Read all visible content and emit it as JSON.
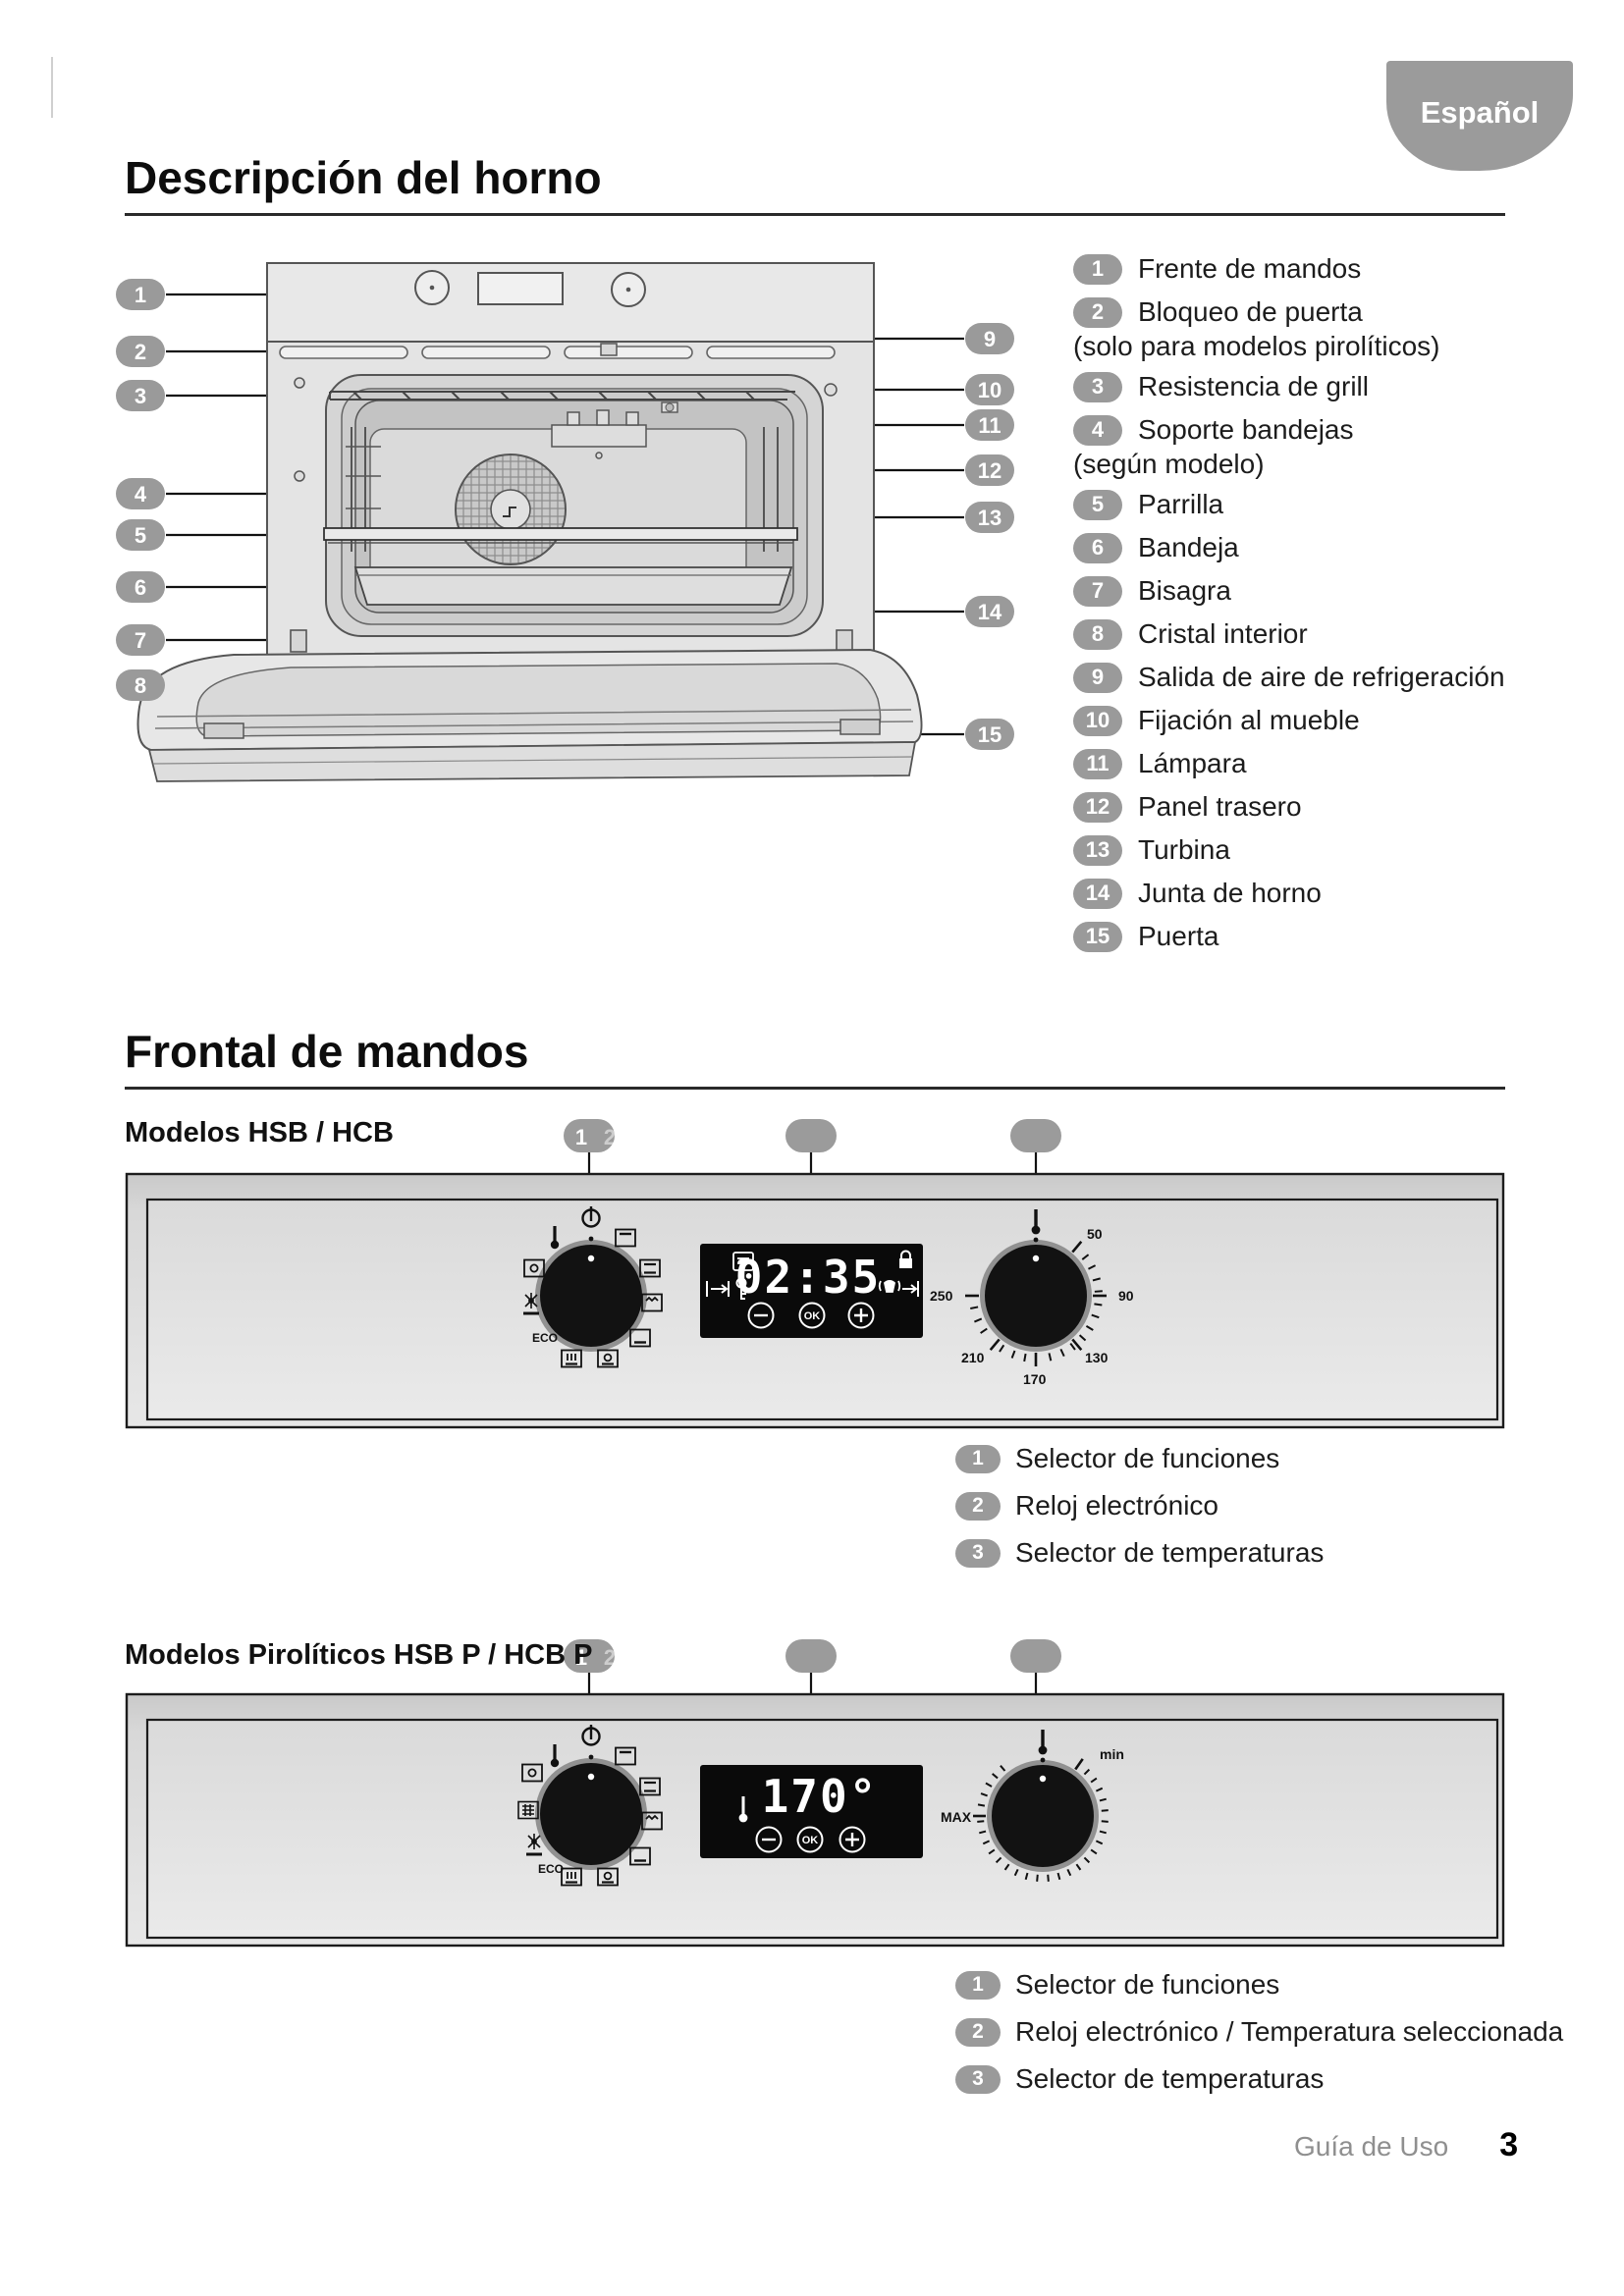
{
  "page": {
    "language_tab": "Español",
    "footer_label": "Guía de Uso",
    "page_number": "3"
  },
  "oven_description": {
    "title": "Descripción del horno",
    "callouts": [
      "1",
      "2",
      "3",
      "4",
      "5",
      "6",
      "7",
      "8",
      "9",
      "10",
      "11",
      "12",
      "13",
      "14",
      "15"
    ],
    "legend": [
      {
        "num": "1",
        "label": "Frente de mandos"
      },
      {
        "num": "2",
        "label": "Bloqueo de puerta",
        "note": "(solo para modelos pirolíticos)"
      },
      {
        "num": "3",
        "label": "Resistencia de grill"
      },
      {
        "num": "4",
        "label": "Soporte bandejas",
        "note": "(según modelo)"
      },
      {
        "num": "5",
        "label": "Parrilla"
      },
      {
        "num": "6",
        "label": "Bandeja"
      },
      {
        "num": "7",
        "label": "Bisagra"
      },
      {
        "num": "8",
        "label": "Cristal interior"
      },
      {
        "num": "9",
        "label": "Salida de aire de refrigeración"
      },
      {
        "num": "10",
        "label": "Fijación al mueble"
      },
      {
        "num": "11",
        "label": "Lámpara"
      },
      {
        "num": "12",
        "label": "Panel trasero"
      },
      {
        "num": "13",
        "label": "Turbina"
      },
      {
        "num": "14",
        "label": "Junta de horno"
      },
      {
        "num": "15",
        "label": "Puerta"
      }
    ]
  },
  "controls": {
    "title": "Frontal de mandos",
    "common": {
      "callout_primary": "1",
      "callout_ghost": "2",
      "eco": "ECO",
      "ok": "OK"
    },
    "panel1": {
      "subtitle": "Modelos HSB / HCB",
      "display_time": "02:35",
      "dial_labels": [
        "50",
        "90",
        "130",
        "170",
        "210",
        "250"
      ],
      "legend": [
        {
          "num": "1",
          "label": "Selector de funciones"
        },
        {
          "num": "2",
          "label": "Reloj electrónico"
        },
        {
          "num": "3",
          "label": "Selector de temperaturas"
        }
      ]
    },
    "panel2": {
      "subtitle": "Modelos Pirolíticos HSB P / HCB P",
      "display_temp": "170°",
      "dial_min": "min",
      "dial_max": "MAX",
      "legend": [
        {
          "num": "1",
          "label": "Selector de funciones"
        },
        {
          "num": "2",
          "label": "Reloj electrónico / Temperatura seleccionada"
        },
        {
          "num": "3",
          "label": "Selector de temperaturas"
        }
      ]
    }
  }
}
